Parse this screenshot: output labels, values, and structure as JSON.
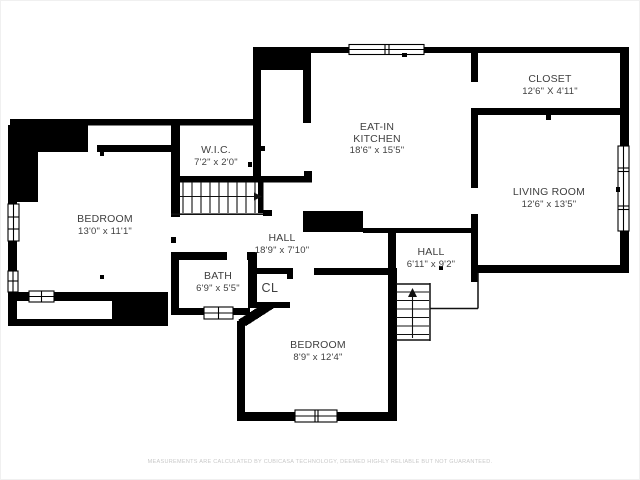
{
  "rooms": {
    "kitchen": {
      "name_line1": "EAT-IN",
      "name_line2": "KITCHEN",
      "dims": "18'6\" x 15'5\""
    },
    "closet": {
      "name": "CLOSET",
      "dims": "12'6\" X 4'11\""
    },
    "living_room": {
      "name": "LIVING ROOM",
      "dims": "12'6\" x 13'5\""
    },
    "wic": {
      "name": "W.I.C.",
      "dims": "7'2\" x 2'0\""
    },
    "bedroom_left": {
      "name": "BEDROOM",
      "dims": "13'0\" x 11'1\""
    },
    "hall_main": {
      "name": "HALL",
      "dims": "18'9\" x 7'10\""
    },
    "hall_right": {
      "name": "HALL",
      "dims": "6'11\" x 9'2\""
    },
    "bath": {
      "name": "BATH",
      "dims": "6'9\" x 5'5\""
    },
    "closet_cl": {
      "name": "CL"
    },
    "bedroom_bottom": {
      "name": "BEDROOM",
      "dims": "8'9\" x 12'4\""
    }
  },
  "footer": {
    "disclaimer": "MEASUREMENTS ARE CALCULATED BY CUBICASA TECHNOLOGY, DEEMED HIGHLY RELIABLE BUT NOT GUARANTEED."
  },
  "colors": {
    "background": "#ffffff",
    "wall": "#000000",
    "label": "#3f3f3f",
    "disclaimer": "#c8c8c8"
  }
}
